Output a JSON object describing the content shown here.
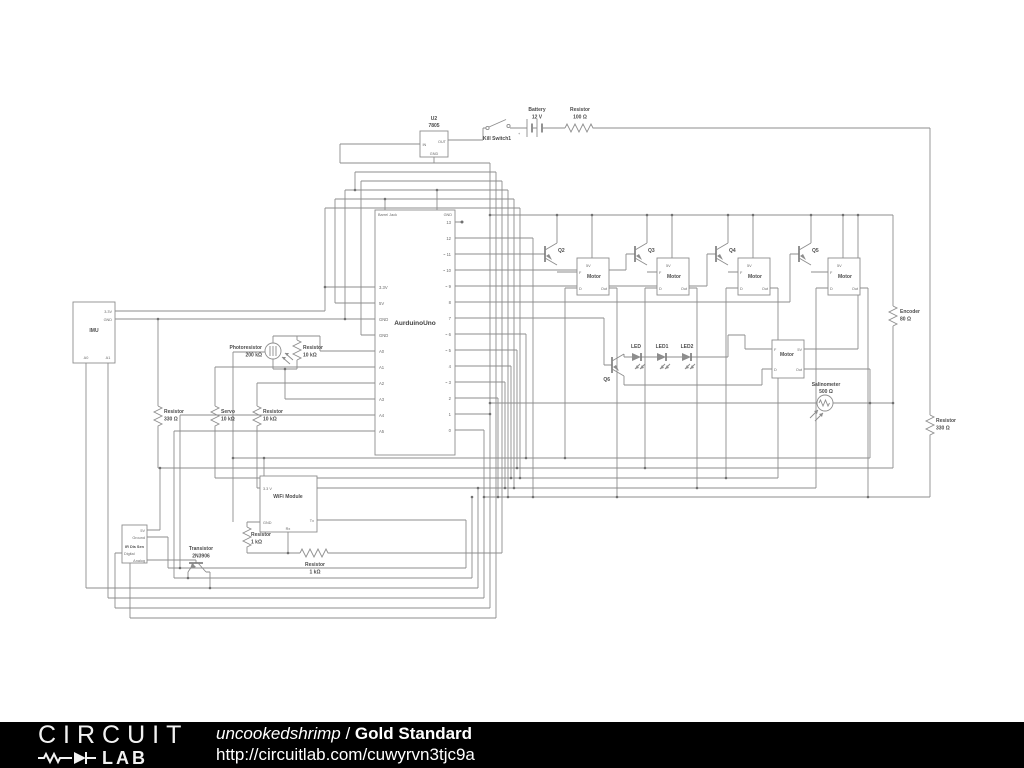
{
  "footer": {
    "logo_line1": "CIRCUIT",
    "logo_line2": "LAB",
    "author": "uncookedshrimp",
    "separator": " / ",
    "title": "Gold Standard",
    "url": "http://circuitlab.com/cuwyrvn3tjc9a",
    "bar_color": "#000000"
  },
  "colors": {
    "wire": "#8d8d8d",
    "label": "#4c4c4c",
    "background": "#ffffff"
  },
  "schematic": {
    "regulator": {
      "ref": "U2",
      "part": "7805",
      "in": "IN",
      "out": "OUT",
      "gnd": "GND"
    },
    "kill_switch": "Kill Switch1",
    "battery": {
      "name": "Battery",
      "value": "12 V",
      "plus": "+"
    },
    "resistor_top": {
      "name": "Resistor",
      "value": "100 Ω"
    },
    "arduino": {
      "name": "AurduinoUno",
      "barrel_jack": "Barrel Jack",
      "gnd_top": "GND",
      "left_pins": [
        "3.3V",
        "5V",
        "GND",
        "GND",
        "A0",
        "A1",
        "A2",
        "A3",
        "A4",
        "A5"
      ],
      "right_pins": [
        "13",
        "12",
        "~ 11",
        "~ 10",
        "~ 9",
        "8",
        "7",
        "~ 6",
        "~ 5",
        "4",
        "~ 3",
        "2",
        "1",
        "0"
      ]
    },
    "q2": "Q2",
    "q3": "Q3",
    "q4": "Q4",
    "q5": "Q5",
    "q6": "Q6",
    "motor": {
      "name": "Motor",
      "p5v": "5V",
      "f": "F",
      "d": "D",
      "out": "Out"
    },
    "leds": [
      "LED",
      "LED1",
      "LED2"
    ],
    "encoder": {
      "name": "Encoder",
      "value": "80 Ω"
    },
    "resistor_right": {
      "name": "Resistor",
      "value": "330 Ω"
    },
    "salinometer": {
      "name": "Salinometer",
      "value": "500 Ω"
    },
    "imu": {
      "name": "IMU",
      "p33": "3.3V",
      "gnd": "GND",
      "a0": "A0",
      "a1": "A1"
    },
    "resistor_330_left": {
      "name": "Resistor",
      "value": "330 Ω"
    },
    "servo": {
      "name": "Servo",
      "value": "10 kΩ"
    },
    "resistor_10k_left": {
      "name": "Resistor",
      "value": "10 kΩ"
    },
    "photoresistor": {
      "name": "Photoresistor",
      "value": "200 kΩ"
    },
    "resistor_10k_photo": {
      "name": "Resistor",
      "value": "10 kΩ"
    },
    "wifi": {
      "name": "WiFi Module",
      "p33": "3.3 V",
      "gnd": "GND",
      "rx": "Rx",
      "tx": "Tx"
    },
    "resistor_1k_vert": {
      "name": "Resistor",
      "value": "1 kΩ"
    },
    "resistor_1k_horiz": {
      "name": "Resistor",
      "value": "1 kΩ"
    },
    "transistor_pnp": {
      "name": "Transistor",
      "part": "2N3906"
    },
    "ir_sensor": {
      "name": "IR Dis Sen",
      "p5v": "5V",
      "ground": "Ground",
      "digital": "Digital",
      "analog": "Analog"
    }
  }
}
